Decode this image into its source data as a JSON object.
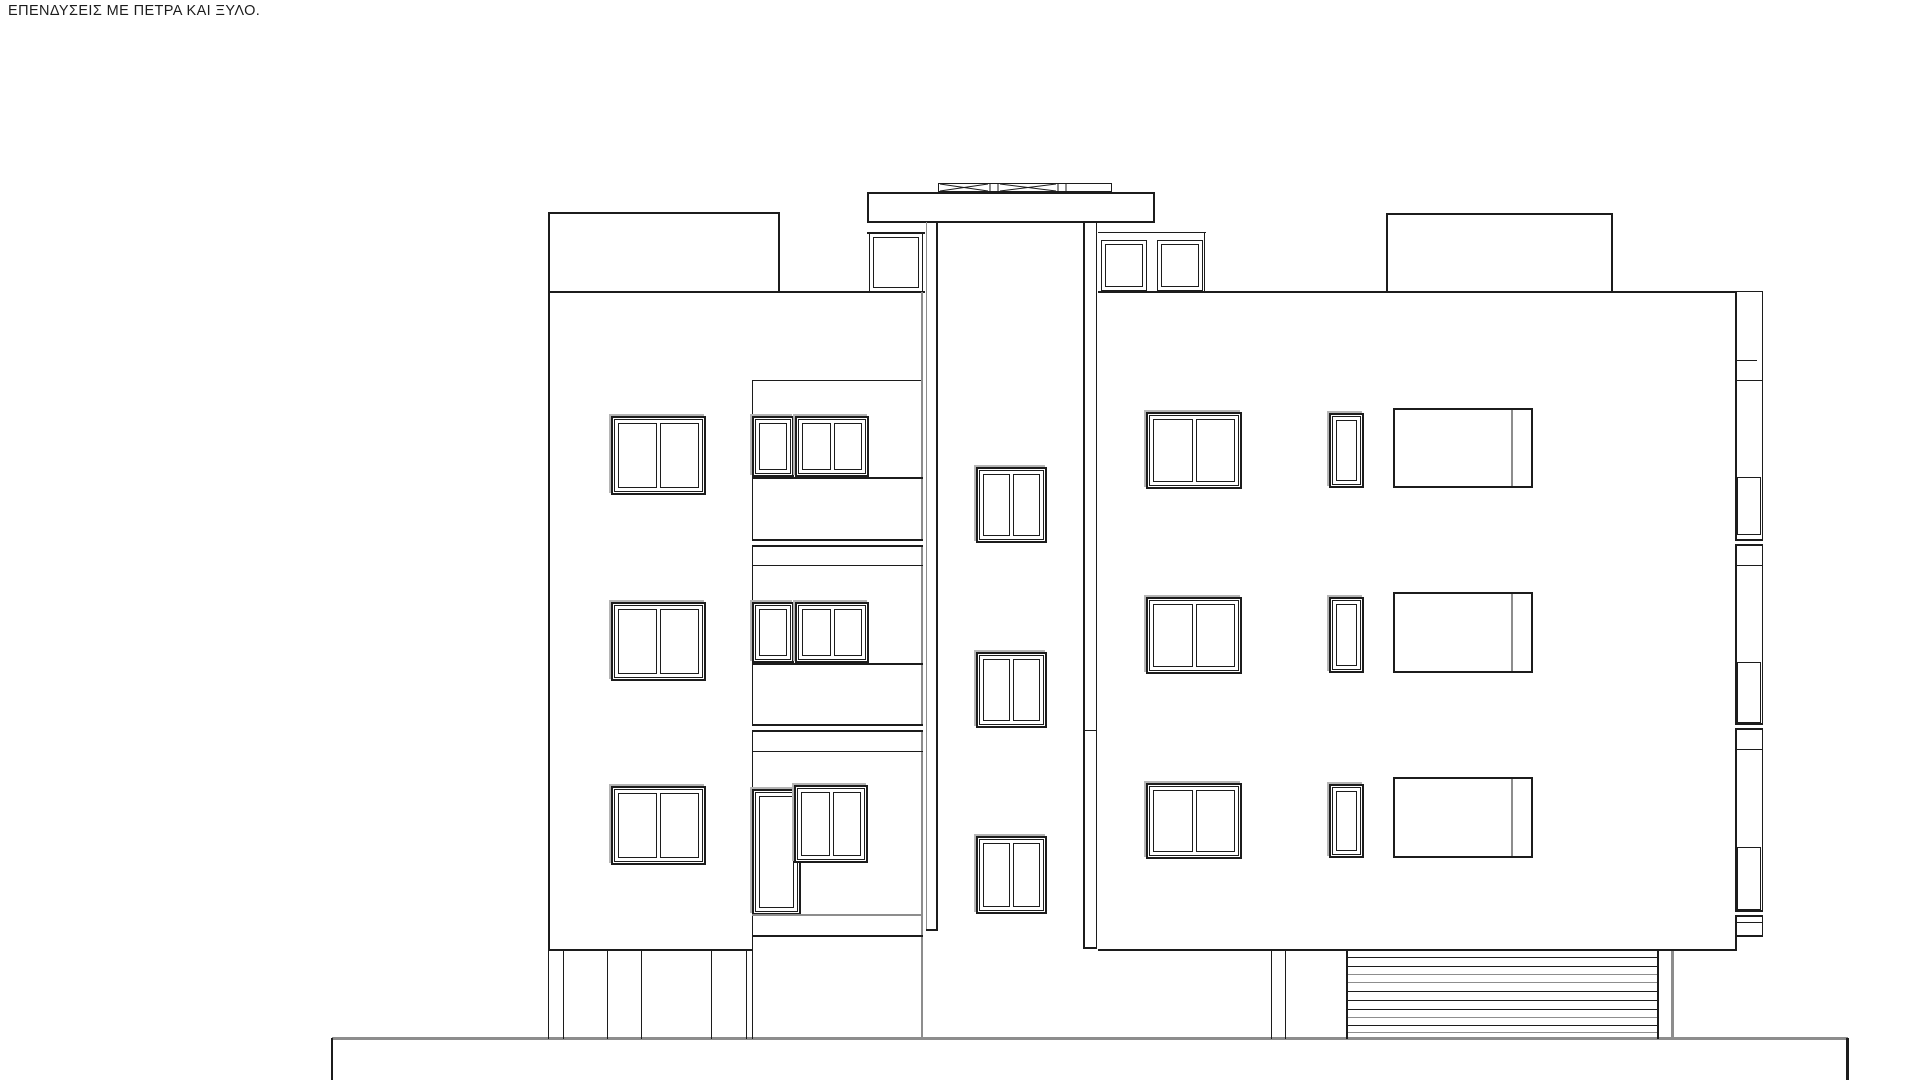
{
  "title_note": "ΕΠΕΝΔΥΣΕΙΣ ΜΕ ΠΕΤΡΑ ΚΑΙ ΞΥΛΟ.",
  "colors": {
    "ink": "#1c1c1c",
    "grey": "#8d8d8d",
    "shadow": "#b5b5b5",
    "background": "#ffffff"
  },
  "drawing": {
    "kind": "building front elevation, line drawing",
    "storeys_visible": 3,
    "features": [
      "left wing with three casement windows",
      "recessed balcony bay with windows, balcony door and slab edges",
      "central stair tower with roof cap, vent row and three landing windows",
      "right wing with casement, narrow and wide windows on three floors",
      "side balcony return strip on far right",
      "open ground floor on piers with roller-shutter garage door",
      "ground base platform"
    ]
  }
}
